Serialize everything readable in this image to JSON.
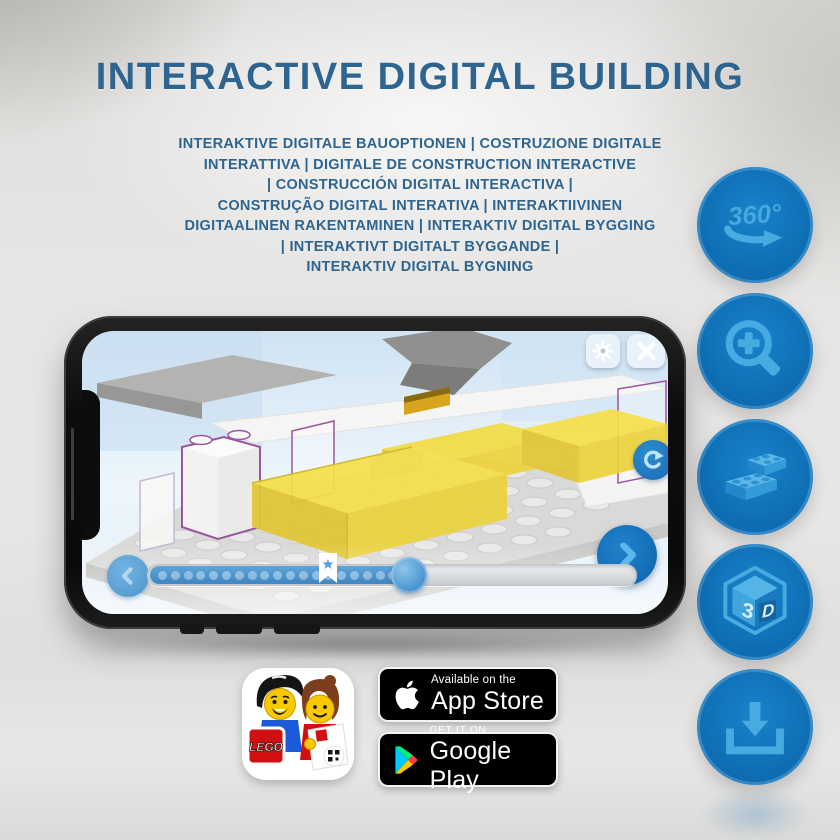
{
  "title": "INTERACTIVE DIGITAL BUILDING",
  "subtitle_lines": [
    "INTERAKTIVE DIGITALE BAUOPTIONEN | COSTRUZIONE DIGITALE",
    "INTERATTIVA | DIGITALE DE CONSTRUCTION INTERACTIVE",
    "| CONSTRUCCIÓN DIGITAL INTERACTIVA |",
    "CONSTRUÇÃO DIGITAL INTERATIVA | INTERAKTIIVINEN",
    "DIGITAALINEN RAKENTAMINEN | INTERAKTIV DIGITAL BYGGING",
    "| INTERAKTIVT DIGITALT BYGGANDE |",
    "INTERAKTIV DIGITAL BYGNING"
  ],
  "features": [
    {
      "name": "360-rotation",
      "label": "360°"
    },
    {
      "name": "zoom-in",
      "label": ""
    },
    {
      "name": "building-bricks",
      "label": ""
    },
    {
      "name": "3d-view",
      "face_left": "3",
      "face_right": "D"
    },
    {
      "name": "download",
      "label": ""
    }
  ],
  "phone": {
    "slider": {
      "dot_count": 21
    }
  },
  "badges": {
    "app_icon_logo": "LEGO",
    "app_store": {
      "line1": "Available on the",
      "line2": "App Store"
    },
    "google_play": {
      "line1": "GET IT ON",
      "line2": "Google Play"
    }
  },
  "colors": {
    "title_blue": "#2e6590",
    "button_blue": "#0f70b6",
    "icon_light_blue": "#47abe2",
    "slider_blue": "#4e97cf",
    "lego_yellow": "#f6e04a"
  }
}
